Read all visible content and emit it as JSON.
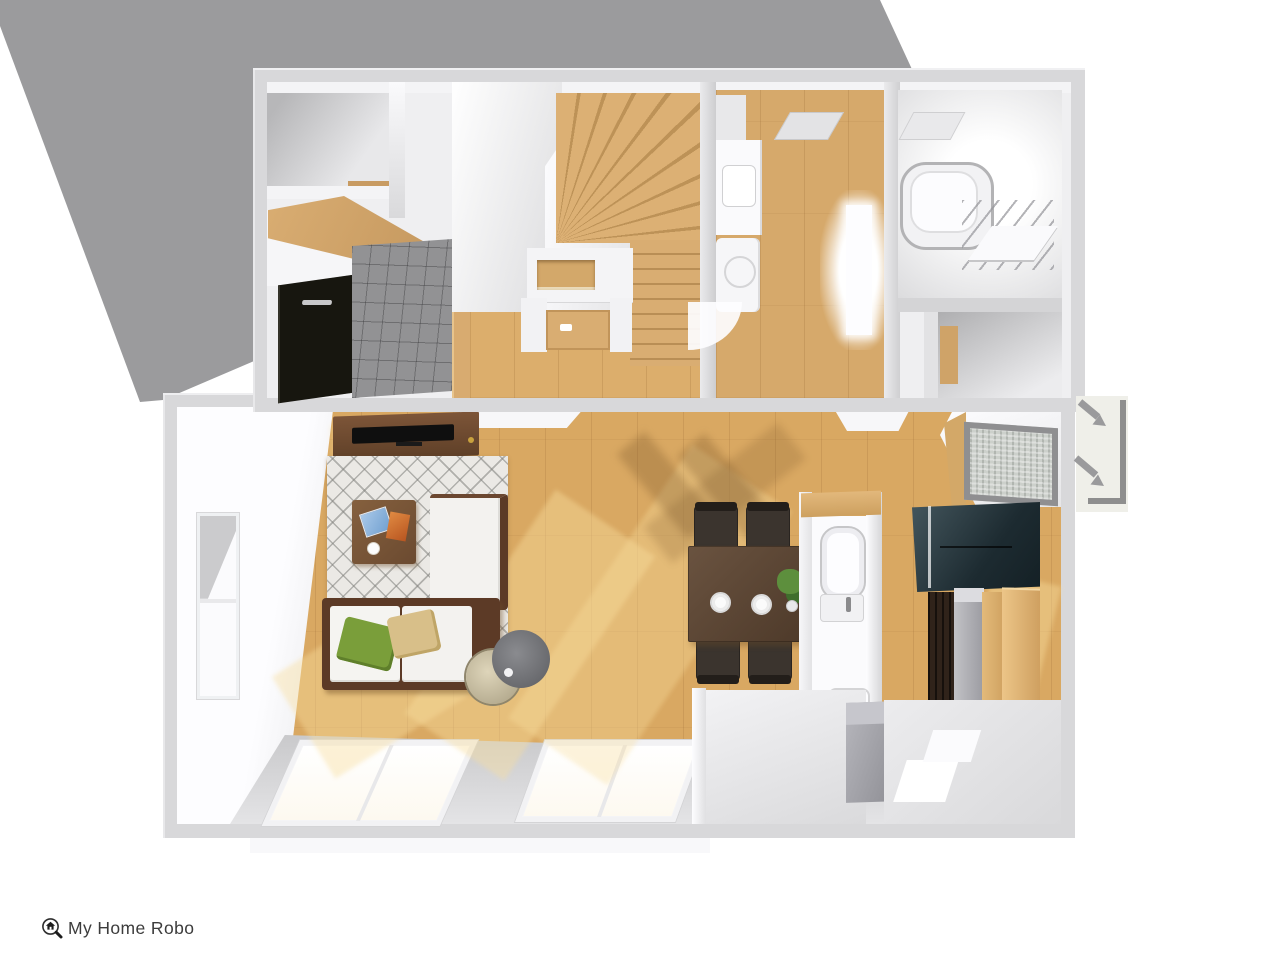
{
  "app": {
    "logo": {
      "text": "My Home Robo",
      "icon": "magnifier-house-icon",
      "text_color": "#3c3c3c"
    }
  },
  "scene": {
    "kind": "3d-floorplan-top-down-render",
    "backdrop": {
      "shape": "diagonal-gray-band-upper-left",
      "color": "#9b9b9d"
    },
    "palette": {
      "canvas": "#ffffff",
      "wall": "#d8d8da",
      "wall_highlight": "#f2f2f4",
      "wood_floor": "#dcae6c",
      "wood_sunlit": "#f7dd9d",
      "stair_wood": "#d9ad72",
      "entry_tile": "#929294",
      "entry_door": "#17160f",
      "rug": "#ebe9e5",
      "rug_pattern": "#80807c",
      "tv_board": "#6f4b33",
      "tv": "#0f0f0f",
      "sofa_frame": "#5c3a26",
      "sofa_cushion": "#f5f4f1",
      "pillow_green": "#7a9e3a",
      "pillow_tan": "#d8bf89",
      "dining_table": "#5a4534",
      "dining_chair": "#3b342e",
      "kitchen_cabinet_navy": "#1d2b31",
      "refrigerator_gray": "#9b9ba1",
      "pantry_wood": "#ddb171",
      "bath_white": "#f7f7f9",
      "lamp_shade_gray": "#737476",
      "lamp_base_cream": "#d6cdb2",
      "porch_panel": "#efefe9",
      "arrow_gray": "#9a9a9c"
    },
    "upper_section": {
      "rooms": [
        {
          "name": "storage-room-nw"
        },
        {
          "name": "entry-genkan",
          "features": [
            "black-double-door",
            "gray-tile-floor",
            "wood-step",
            "wood-canopy"
          ]
        },
        {
          "name": "hallway",
          "features": [
            "wood-floor",
            "interior-door-open",
            "wall-niche"
          ]
        },
        {
          "name": "staircase",
          "features": [
            "winder-treads",
            "straight-run"
          ]
        },
        {
          "name": "washroom",
          "features": [
            "vanity",
            "washing-machine",
            "window-glow",
            "ceiling-vent",
            "door-swing-arc"
          ]
        },
        {
          "name": "bathroom",
          "features": [
            "bathtub",
            "shower-glass",
            "ceiling-vent",
            "counter"
          ]
        },
        {
          "name": "storage-room-se",
          "features": [
            "wood-sliver"
          ]
        }
      ]
    },
    "lower_section": {
      "rooms": [
        {
          "name": "living-area"
        },
        {
          "name": "dining-area"
        },
        {
          "name": "kitchen"
        },
        {
          "name": "toilet-room"
        },
        {
          "name": "rear-hall"
        }
      ],
      "furniture": [
        "tv-board",
        "tv",
        "patterned-rug",
        "coffee-table",
        "tablet",
        "orange-box",
        "small-plate",
        "l-shaped-sofa",
        "green-pillow",
        "tan-pillow",
        "floor-lamp",
        "dining-table",
        "dining-chair-x4",
        "plate-x2",
        "potted-plant",
        "kitchen-navy-cabinet",
        "tall-brown-cabinet",
        "refrigerator",
        "pantry-panel-x2",
        "toilet",
        "washbasin",
        "gray-storage-box"
      ],
      "windows": [
        "left-wall-window",
        "south-sliding-window-1",
        "south-sliding-window-2",
        "south-window-3",
        "kitchen-north-window"
      ]
    },
    "annotations": {
      "entry_direction_arrows": 2,
      "porch_border": "dark-gray-L"
    }
  }
}
